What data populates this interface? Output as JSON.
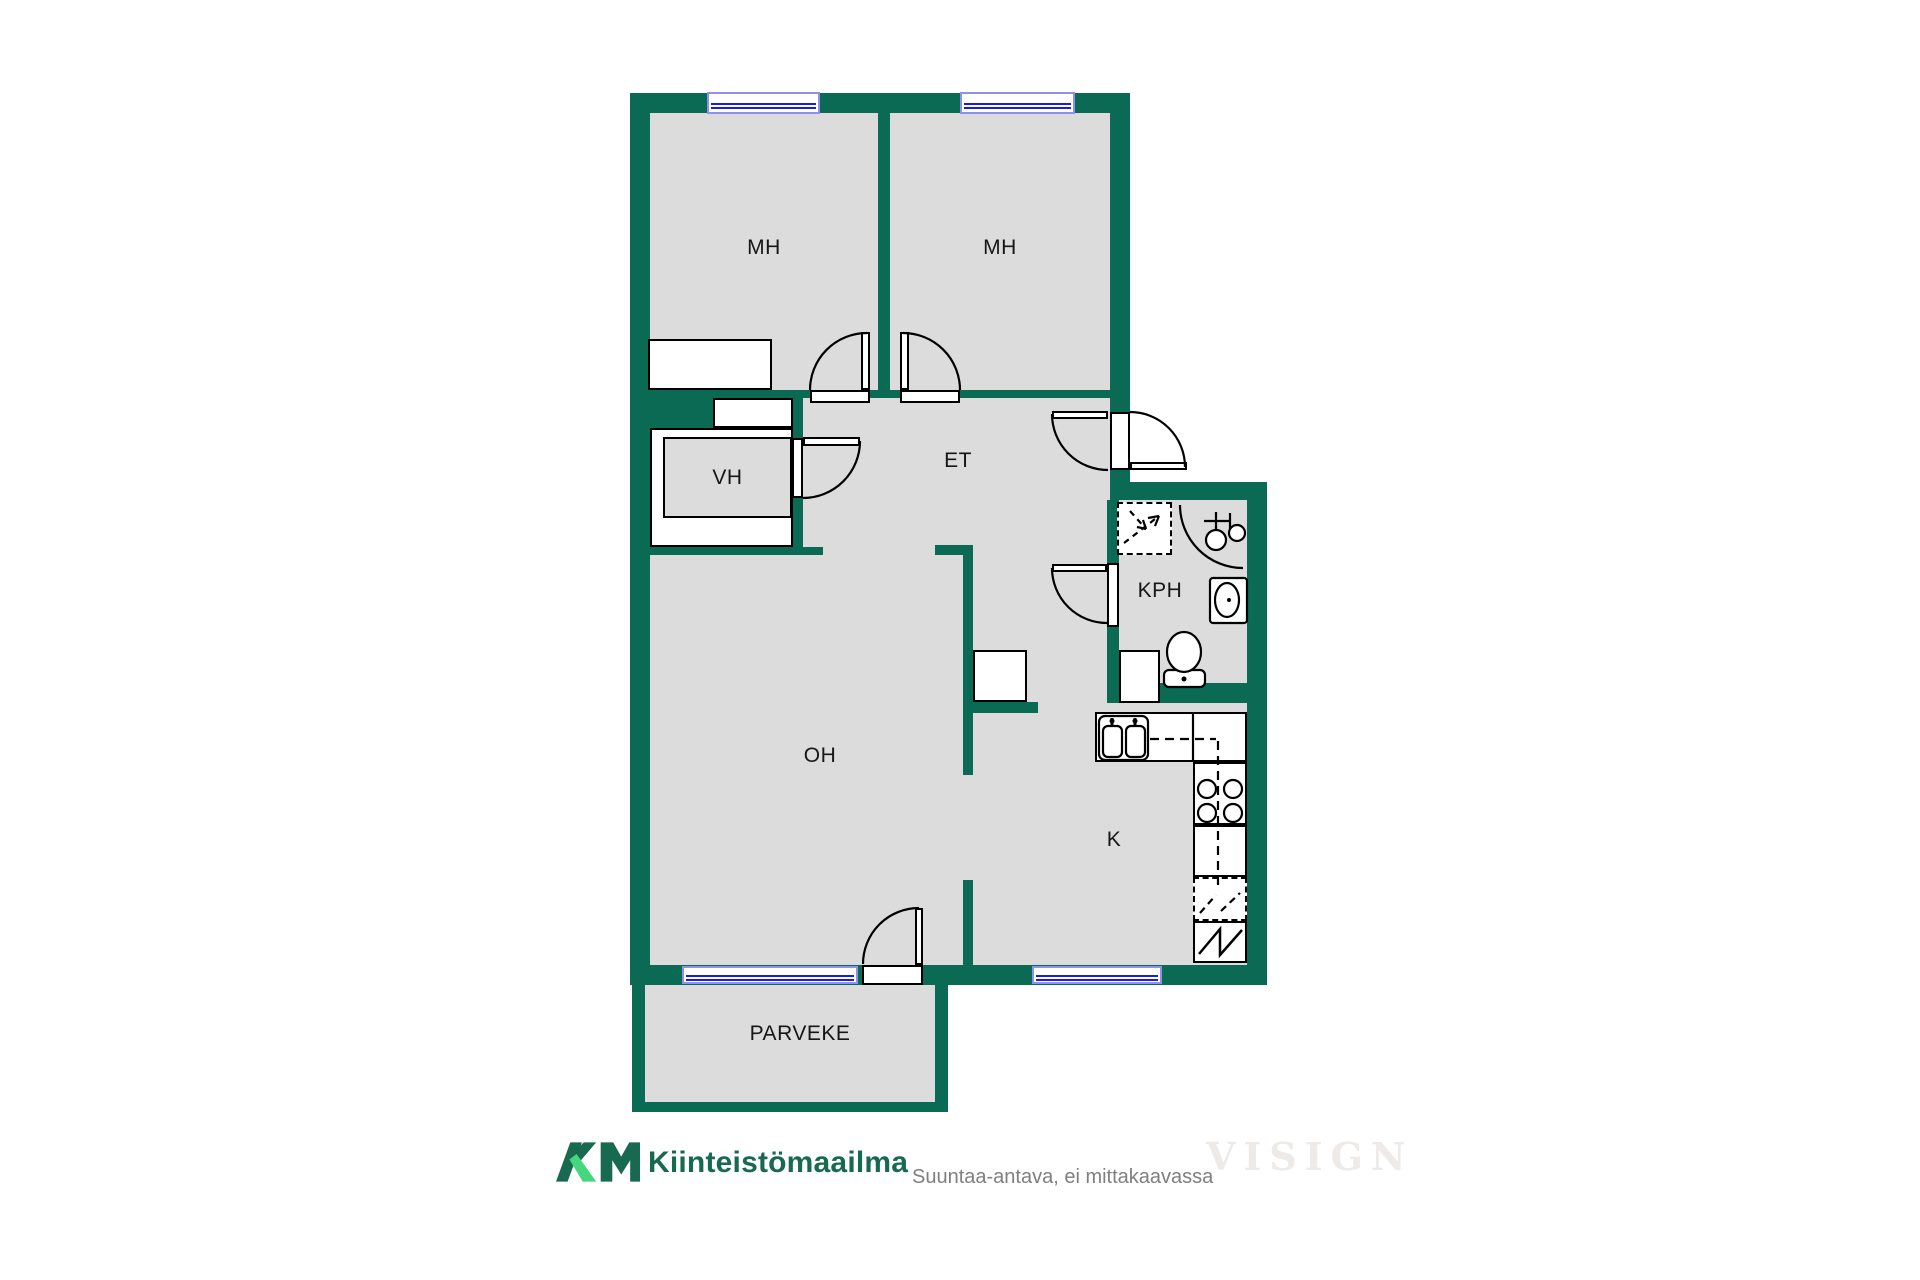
{
  "title": "Apartment floor plan",
  "colors": {
    "wall_green": "#0A6A54",
    "floor_gray": "#DCDCDC",
    "outline_black": "#000000",
    "window_frame_blue": "#9090F0",
    "window_glass_blue": "#1A1AE6",
    "logo_dark_green": "#17694F",
    "logo_light_green": "#45D77D",
    "disclaimer_gray": "#7F7F7F",
    "watermark_gray": "#EDEAE7"
  },
  "rooms": [
    {
      "id": "mh-left",
      "label": "MH"
    },
    {
      "id": "mh-right",
      "label": "MH"
    },
    {
      "id": "et",
      "label": "ET"
    },
    {
      "id": "vh",
      "label": "VH"
    },
    {
      "id": "kph",
      "label": "KPH"
    },
    {
      "id": "oh",
      "label": "OH"
    },
    {
      "id": "k",
      "label": "K"
    },
    {
      "id": "parveke",
      "label": "PARVEKE"
    }
  ],
  "fixtures": [
    "wardrobe",
    "closet-shelf",
    "shower-symbol",
    "faucet-icon",
    "washbasin-icon",
    "toilet-icon",
    "washing-machine-slot",
    "kitchen-sink-icon",
    "stove-burners-icon",
    "counter",
    "fridge-reservation-icon",
    "appliance-zigzag-icon",
    "kitchen-peninsula"
  ],
  "doors": [
    "bedroom-left-door",
    "bedroom-right-door",
    "closet-door",
    "entry-door-inner",
    "entry-door-outer",
    "bathroom-door",
    "balcony-door"
  ],
  "windows": [
    "bedroom-left-window",
    "bedroom-right-window",
    "livingroom-window",
    "kitchen-window"
  ],
  "footer": {
    "logo_mark": "KM",
    "logo_text": "Kiinteistömaailma",
    "disclaimer": "Suuntaa-antava, ei mittakaavassa",
    "watermark": "VISIGN"
  }
}
